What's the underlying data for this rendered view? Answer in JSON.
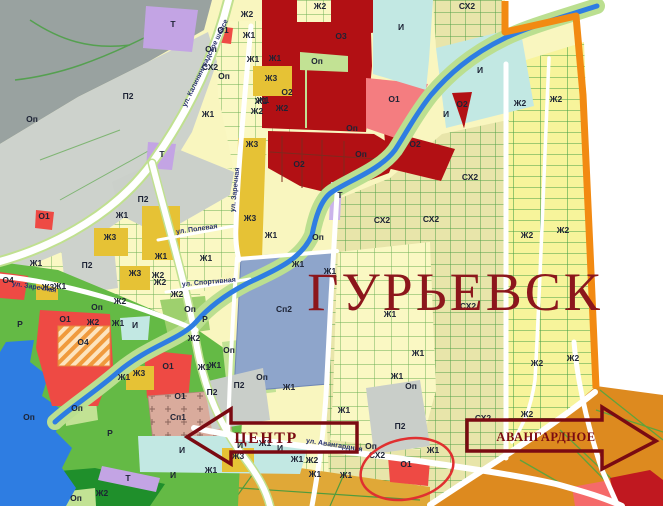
{
  "map": {
    "title": "ГУРЬЕВСК",
    "arrows": [
      {
        "label": "ЦЕНТР",
        "direction": "left"
      },
      {
        "label": "АВАНГАРДНОЕ",
        "direction": "right"
      }
    ],
    "highlight_circle_target": "О1",
    "streets": [
      {
        "t": "ул. Калининградское шоссе",
        "x": 207,
        "y": 64,
        "r": -64
      },
      {
        "t": "ул. Заречная",
        "x": 237,
        "y": 190,
        "r": -84
      },
      {
        "t": "ул. Полевая",
        "x": 197,
        "y": 231,
        "r": -8
      },
      {
        "t": "ул. Спортивная",
        "x": 209,
        "y": 284,
        "r": -5
      },
      {
        "t": "ул. Заречная",
        "x": 34,
        "y": 289,
        "r": 9
      },
      {
        "t": "ул. Авангардная",
        "x": 334,
        "y": 447,
        "r": 9
      }
    ],
    "zone_labels": [
      {
        "t": "Т",
        "x": 173,
        "y": 27
      },
      {
        "t": "Ж2",
        "x": 247,
        "y": 17
      },
      {
        "t": "Ж1",
        "x": 249,
        "y": 38
      },
      {
        "t": "О1",
        "x": 223,
        "y": 33
      },
      {
        "t": "Оп",
        "x": 211,
        "y": 52
      },
      {
        "t": "СХ2",
        "x": 210,
        "y": 70
      },
      {
        "t": "Оп",
        "x": 224,
        "y": 79
      },
      {
        "t": "Ж1",
        "x": 253,
        "y": 62
      },
      {
        "t": "Ж1",
        "x": 275,
        "y": 61
      },
      {
        "t": "Ж3",
        "x": 271,
        "y": 81
      },
      {
        "t": "Ж1",
        "x": 261,
        "y": 104
      },
      {
        "t": "Ж2",
        "x": 282,
        "y": 111
      },
      {
        "t": "Ж2",
        "x": 257,
        "y": 114
      },
      {
        "t": "Ж1",
        "x": 208,
        "y": 117
      },
      {
        "t": "П2",
        "x": 128,
        "y": 99
      },
      {
        "t": "Оп",
        "x": 32,
        "y": 122
      },
      {
        "t": "Т",
        "x": 162,
        "y": 157
      },
      {
        "t": "Ж2",
        "x": 320,
        "y": 9
      },
      {
        "t": "О3",
        "x": 341,
        "y": 39
      },
      {
        "t": "Оп",
        "x": 317,
        "y": 64
      },
      {
        "t": "О2",
        "x": 287,
        "y": 95
      },
      {
        "t": "И",
        "x": 401,
        "y": 30
      },
      {
        "t": "О1",
        "x": 394,
        "y": 102
      },
      {
        "t": "Оп",
        "x": 352,
        "y": 131
      },
      {
        "t": "Оп",
        "x": 361,
        "y": 157
      },
      {
        "t": "О2",
        "x": 299,
        "y": 167
      },
      {
        "t": "СХ2",
        "x": 467,
        "y": 9
      },
      {
        "t": "И",
        "x": 480,
        "y": 73
      },
      {
        "t": "О2",
        "x": 462,
        "y": 107
      },
      {
        "t": "И",
        "x": 446,
        "y": 117
      },
      {
        "t": "Ж2",
        "x": 520,
        "y": 106
      },
      {
        "t": "Ж2",
        "x": 556,
        "y": 102
      },
      {
        "t": "О2",
        "x": 415,
        "y": 147
      },
      {
        "t": "Ж3",
        "x": 252,
        "y": 147
      },
      {
        "t": "Ж3",
        "x": 250,
        "y": 221
      },
      {
        "t": "Т",
        "x": 340,
        "y": 198
      },
      {
        "t": "Оп",
        "x": 318,
        "y": 240
      },
      {
        "t": "СХ2",
        "x": 382,
        "y": 223
      },
      {
        "t": "СХ2",
        "x": 431,
        "y": 222
      },
      {
        "t": "СХ2",
        "x": 470,
        "y": 180
      },
      {
        "t": "Ж1",
        "x": 271,
        "y": 238
      },
      {
        "t": "Ж1",
        "x": 298,
        "y": 267
      },
      {
        "t": "Ж1",
        "x": 330,
        "y": 274
      },
      {
        "t": "Сп2",
        "x": 284,
        "y": 312
      },
      {
        "t": "Ж1",
        "x": 390,
        "y": 317
      },
      {
        "t": "СХ2",
        "x": 468,
        "y": 309
      },
      {
        "t": "Ж2",
        "x": 527,
        "y": 238
      },
      {
        "t": "Ж2",
        "x": 563,
        "y": 233
      },
      {
        "t": "П2",
        "x": 143,
        "y": 202
      },
      {
        "t": "Ж1",
        "x": 122,
        "y": 218
      },
      {
        "t": "Ж3",
        "x": 110,
        "y": 240
      },
      {
        "t": "О1",
        "x": 44,
        "y": 219
      },
      {
        "t": "Ж1",
        "x": 161,
        "y": 259
      },
      {
        "t": "Ж1",
        "x": 206,
        "y": 261
      },
      {
        "t": "П2",
        "x": 87,
        "y": 268
      },
      {
        "t": "Ж1",
        "x": 36,
        "y": 266
      },
      {
        "t": "Ж3",
        "x": 135,
        "y": 276
      },
      {
        "t": "Ж2",
        "x": 158,
        "y": 278
      },
      {
        "t": "Ж2",
        "x": 177,
        "y": 297
      },
      {
        "t": "Ж2",
        "x": 120,
        "y": 304
      },
      {
        "t": "Ж3",
        "x": 48,
        "y": 290
      },
      {
        "t": "Ж1",
        "x": 60,
        "y": 289
      },
      {
        "t": "Ж2",
        "x": 93,
        "y": 325
      },
      {
        "t": "Ж1",
        "x": 118,
        "y": 326
      },
      {
        "t": "Оп",
        "x": 97,
        "y": 310
      },
      {
        "t": "Оп",
        "x": 190,
        "y": 312
      },
      {
        "t": "Р",
        "x": 20,
        "y": 327
      },
      {
        "t": "Р",
        "x": 205,
        "y": 322
      },
      {
        "t": "О1",
        "x": 65,
        "y": 322
      },
      {
        "t": "О4",
        "x": 8,
        "y": 283
      },
      {
        "t": "О4",
        "x": 83,
        "y": 345
      },
      {
        "t": "И",
        "x": 135,
        "y": 328
      },
      {
        "t": "Ж2",
        "x": 160,
        "y": 285
      },
      {
        "t": "Ж2",
        "x": 194,
        "y": 341
      },
      {
        "t": "Ж1",
        "x": 124,
        "y": 380
      },
      {
        "t": "Ж3",
        "x": 139,
        "y": 376
      },
      {
        "t": "О1",
        "x": 168,
        "y": 369
      },
      {
        "t": "О1",
        "x": 180,
        "y": 399
      },
      {
        "t": "Сп1",
        "x": 178,
        "y": 420
      },
      {
        "t": "Р",
        "x": 110,
        "y": 436
      },
      {
        "t": "Оп",
        "x": 77,
        "y": 411
      },
      {
        "t": "Оп",
        "x": 29,
        "y": 420
      },
      {
        "t": "Ж1",
        "x": 204,
        "y": 370
      },
      {
        "t": "П2",
        "x": 239,
        "y": 388
      },
      {
        "t": "П2",
        "x": 212,
        "y": 395
      },
      {
        "t": "Оп",
        "x": 229,
        "y": 353
      },
      {
        "t": "Ж1",
        "x": 215,
        "y": 368
      },
      {
        "t": "Оп",
        "x": 262,
        "y": 380
      },
      {
        "t": "Ж1",
        "x": 289,
        "y": 390
      },
      {
        "t": "Ж1",
        "x": 344,
        "y": 413
      },
      {
        "t": "Ж1",
        "x": 418,
        "y": 356
      },
      {
        "t": "Ж1",
        "x": 397,
        "y": 379
      },
      {
        "t": "Оп",
        "x": 411,
        "y": 389
      },
      {
        "t": "П2",
        "x": 400,
        "y": 429
      },
      {
        "t": "Оп",
        "x": 371,
        "y": 449
      },
      {
        "t": "СХ2",
        "x": 377,
        "y": 458
      },
      {
        "t": "О1",
        "x": 406,
        "y": 467
      },
      {
        "t": "Ж2",
        "x": 527,
        "y": 417
      },
      {
        "t": "СХ2",
        "x": 483,
        "y": 421
      },
      {
        "t": "Ж2",
        "x": 537,
        "y": 366
      },
      {
        "t": "Ж2",
        "x": 573,
        "y": 361
      },
      {
        "t": "И",
        "x": 182,
        "y": 453
      },
      {
        "t": "И",
        "x": 240,
        "y": 448
      },
      {
        "t": "И",
        "x": 280,
        "y": 451
      },
      {
        "t": "И",
        "x": 173,
        "y": 478
      },
      {
        "t": "Ж1",
        "x": 211,
        "y": 473
      },
      {
        "t": "Т",
        "x": 128,
        "y": 481
      },
      {
        "t": "Ж2",
        "x": 102,
        "y": 496
      },
      {
        "t": "Оп",
        "x": 76,
        "y": 501
      },
      {
        "t": "Ж3",
        "x": 238,
        "y": 459
      },
      {
        "t": "Ж2",
        "x": 312,
        "y": 463
      },
      {
        "t": "Ж1",
        "x": 297,
        "y": 462
      },
      {
        "t": "Ж1",
        "x": 315,
        "y": 477
      },
      {
        "t": "Ж1",
        "x": 346,
        "y": 478
      },
      {
        "t": "Ж1",
        "x": 433,
        "y": 453
      },
      {
        "t": "Ж1",
        "x": 265,
        "y": 446
      },
      {
        "t": "Ж1",
        "x": 263,
        "y": 103
      }
    ],
    "zone_colors": {
      "Ж1_residential": "#faf8c3",
      "Ж2_residential": "#f7f49b",
      "Ж3_residential": "#e6c235",
      "О1_public": "#ee4a44",
      "О1_public_alt": "#f47d80",
      "О2_О3_public": "#b21014",
      "О4_hatched": "#f09a3d",
      "П2_industrial": "#cdd2cc",
      "Т_transport": "#c3a4e4",
      "И_engineering": "#c2e8e3",
      "Р_recreation": "#64ba45",
      "Оп_greenery": "#c2e294",
      "СХ2_agricultural": "#e8e5aa",
      "Сп1_cemetery": "#d9ab9c",
      "Сп2_special": "#8ea5cb",
      "water": "#2e7de2",
      "boundary": "#f28a12",
      "road": "#ffffff",
      "annotation_arrow": "#7a0a12",
      "highlight_circle": "#e03030",
      "title_color": "#8c161c"
    }
  }
}
